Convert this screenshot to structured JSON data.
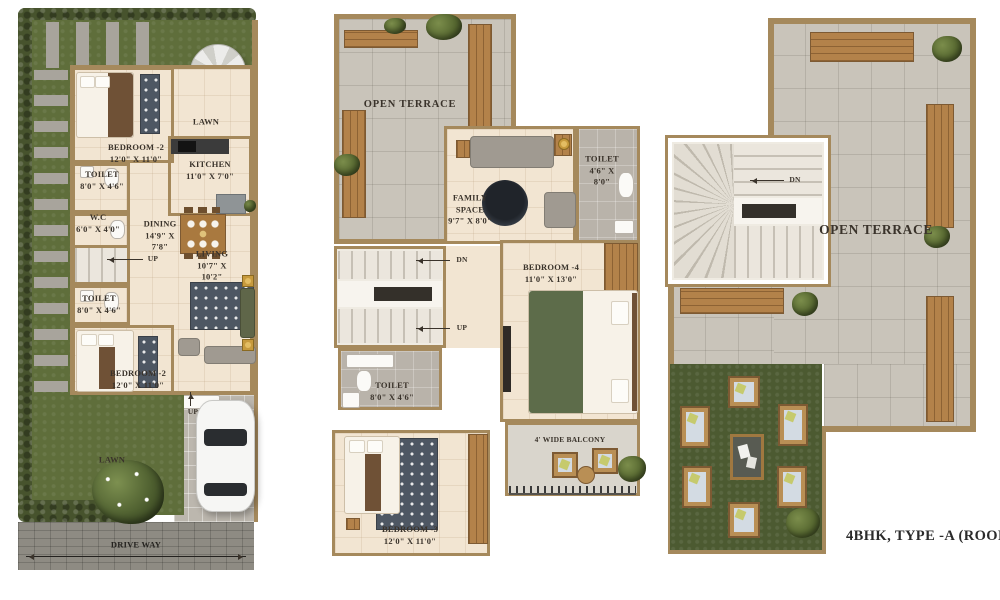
{
  "plans": {
    "ground": {
      "lawn_top": "LAWN",
      "bedroom_top": {
        "name": "BEDROOM -2",
        "dims": "12'0\" X 11'0\""
      },
      "toilet_top": {
        "name": "TOILET",
        "dims": "8'0\" X 4'6\""
      },
      "wc": {
        "name": "W.C",
        "dims": "6'0\" X 4'0\""
      },
      "kitchen": {
        "name": "KITCHEN",
        "dims": "11'0\" X 7'0\""
      },
      "dining": {
        "name": "DINING",
        "dims": "14'9\" X\n7'8\""
      },
      "up_stairs": "UP",
      "living": {
        "name": "LIVING",
        "dims": "10'7\" X 10'2\""
      },
      "toilet_bottom": {
        "name": "TOILET",
        "dims": "8'0\" X 4'6\""
      },
      "bedroom_bottom": {
        "name": "BEDROOM -2",
        "dims": "12'0\" X 11'0\""
      },
      "up_entry": "UP",
      "lawn_bottom": "LAWN",
      "driveway": "DRIVE WAY"
    },
    "first": {
      "open_terrace": "OPEN TERRACE",
      "family_space": {
        "name": "FAMILY\nSPACE",
        "dims": "9'7\" X 8'0\""
      },
      "toilet_top": {
        "name": "TOILET",
        "dims": "4'6\" X 8'0\""
      },
      "dn": "DN",
      "up": "UP",
      "bedroom4": {
        "name": "BEDROOM -4",
        "dims": "11'0\" X 13'0\""
      },
      "toilet_mid": {
        "name": "TOILET",
        "dims": "8'0\" X 4'6\""
      },
      "bedroom3": {
        "name": "BEDROOM -3",
        "dims": "12'0\" X 11'0\""
      },
      "balcony": "4' WIDE BALCONY"
    },
    "roof": {
      "dn": "DN",
      "open_terrace": "OPEN TERRACE",
      "caption": "4BHK, TYPE -A (ROOF PLAN"
    }
  },
  "colors": {
    "wall": "#a5895c",
    "lawn": "#5f6e3b",
    "hedge": "#47532d",
    "floor": "#f2e5d2",
    "terrace": "#c9c4ba",
    "wood": "#b3824a"
  }
}
